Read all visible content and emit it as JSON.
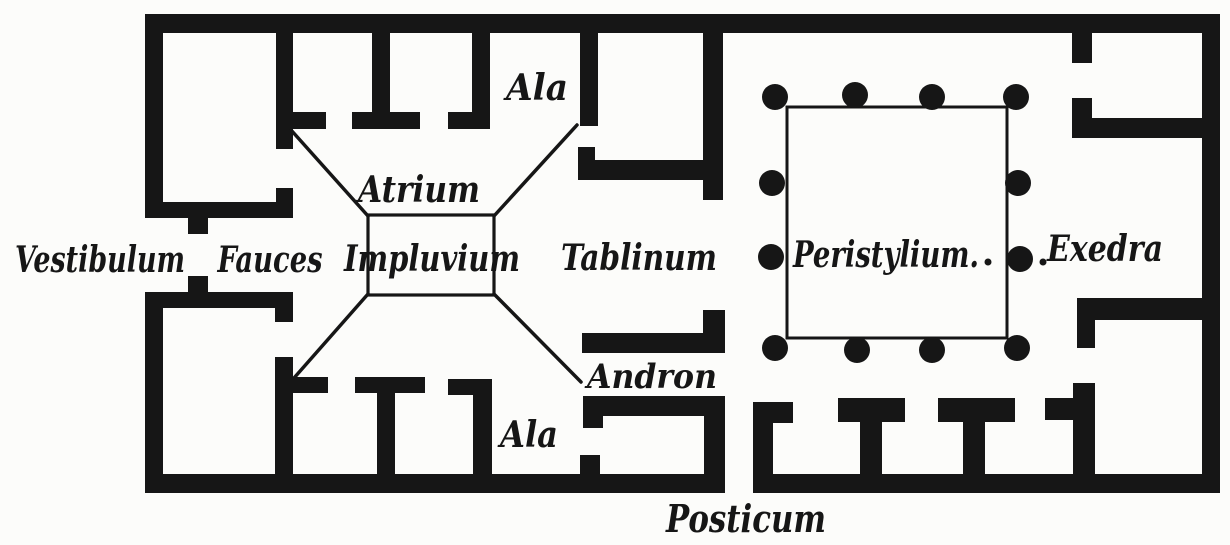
{
  "figure": {
    "background": "#fcfcfa",
    "ink": "#161616"
  },
  "labels": {
    "vestibulum": "Vestibulum",
    "fauces": "Fauces",
    "atrium": "Atrium",
    "impluvium": "Impluvium",
    "ala_top": "Ala",
    "tablinum": "Tablinum",
    "andron": "Andron",
    "ala_bottom": "Ala",
    "peristylium": "Peristylium.",
    "exedra": "Exedra",
    "posticum": "Posticum"
  }
}
